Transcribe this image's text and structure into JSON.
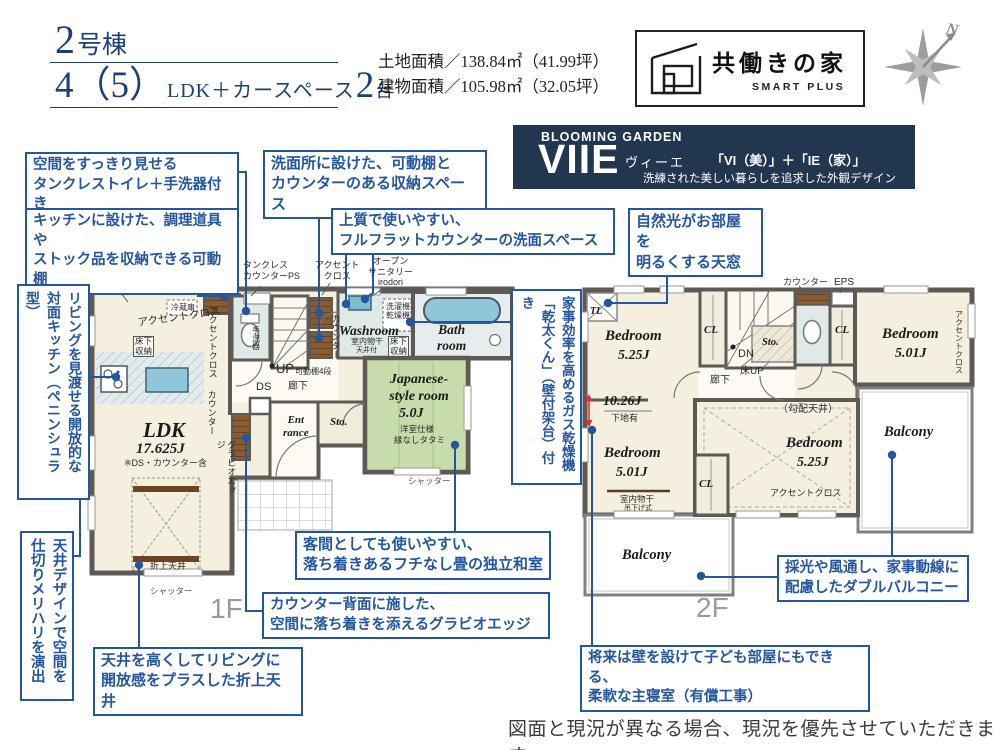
{
  "header": {
    "unit_num": "2",
    "unit_suffix": "号棟",
    "plan_num": "4（5）",
    "plan_mid": "LDK＋カースペース",
    "plan_num2": "2",
    "plan_unit": "台",
    "land_area": "土地面積／138.84㎡（41.99坪）",
    "building_area": "建物面積／105.98㎡（32.05坪）",
    "brand_name": "共働きの家",
    "brand_sub": "SMART PLUS",
    "compass_n": "N"
  },
  "banner": {
    "series": "BLOOMING GARDEN",
    "logo": "VIIE",
    "kana": "ヴィーエ",
    "formula": "「VI（美）」＋「IE（家）」",
    "tagline": "洗練された美しい暮らしを追求した外観デザイン"
  },
  "callouts": {
    "tankless": "空間をすっきり見せる\nタンクレストイレ＋手洗器付き",
    "kitchen_shelf": "キッチンに設けた、調理道具や\nストック品を収納できる可動棚",
    "washroom_storage": "洗面所に設けた、可動棚と\nカウンターのある収納スペース",
    "flat_counter": "上質で使いやすい、\nフルフラットカウンターの洗面スペース",
    "skylight": "自然光がお部屋を\n明るくする天窓",
    "peninsula": "リビングを見渡せる開放的な\n対面キッチン（ペニンシュラ型）",
    "ceiling_design": "天井デザインで空間を\n仕切りメリハリを演出",
    "gas_dryer": "家事効率を高めるガス乾燥機\n「乾太くん」（壁付架台）付き",
    "tatami": "客間としても使いやすい、\n落ち着きあるフチなし畳の独立和室",
    "gravio": "カウンター背面に施した、\n空間に落ち着きを添えるグラビオエッジ",
    "oriage": "天井を高くしてリビングに\n開放感をプラスした折上天井",
    "double_balcony": "採光や風通し、家事動線に\n配慮したダブルバルコニー",
    "main_bedroom": "将来は壁を設けて子ども部屋にもできる、\n柔軟な主寝室（有償工事）"
  },
  "plan1f": {
    "floor": "1F",
    "tenjo_dn": "天井DN",
    "kadoudana_top": "可動棚4段",
    "tankless_ps": "タンクレス\nカウンターPS",
    "reizouko": "冷蔵庫",
    "accent_diag": "アクセントクロス",
    "accent_vert": "アクセントクロス",
    "yukashita": "床下\n収納",
    "tearaiki": "手洗器",
    "popup": "ポップアップ天井",
    "ldk": "LDK",
    "ldk_size": "17.625J",
    "ldk_note": "※DS・カウンター含",
    "oriage": "折上天井",
    "shutter": "シャッター",
    "counter_v": "カウンター",
    "gravio_v": "グラビオエッジ",
    "up": "UP",
    "kadoudana_mid": "可動棚4段",
    "rouka": "廊下",
    "ds": "DS",
    "counter_v2": "カウンター",
    "accent_wash": "アクセント\nクロス",
    "open_sanitary": "オープン\nサニタリー\nirodori",
    "washer": "洗濯機\n乾燥機",
    "washroom": "Washroom",
    "monohoshi": "室内物干",
    "tenjotsuke": "天井付",
    "yukashita2": "床下\n収納",
    "bath": "Bath\nroom",
    "japanese": "Japanese-\nstyle room",
    "japanese_size": "5.0J",
    "japanese_note1": "洋室仕様",
    "japanese_note2": "縁なしタタミ",
    "sto": "Sto.",
    "entrance": "Ent\nrance",
    "shutter2": "シャッター"
  },
  "plan2f": {
    "floor": "2F",
    "tl": "TL",
    "bedroom1": "Bedroom",
    "bedroom1_size": "5.25J",
    "combined": "10.26J",
    "shitaji": "下地有",
    "bedroom2": "Bedroom",
    "bedroom2_size": "5.01J",
    "monohoshi": "室内物干",
    "tsurisage": "吊下げ式",
    "cl1": "CL",
    "cl2": "CL",
    "cl3": "CL",
    "dn": "DN",
    "sto": "Sto.",
    "yuka_up": "床UP",
    "rouka": "廊下",
    "counter": "カウンター",
    "eps": "EPS",
    "bedroom3": "Bedroom",
    "bedroom3_size": "5.01J",
    "accent_v": "アクセントクロス",
    "kobai": "（勾配天井）",
    "bedroom4": "Bedroom",
    "bedroom4_size": "5.25J",
    "accent_h": "アクセントクロス",
    "balcony1": "Balcony",
    "balcony2": "Balcony"
  },
  "footer": {
    "note": "図面と現況が異なる場合、現況を優先させていただきます。"
  },
  "colors": {
    "navy": "#2456a0",
    "header_navy": "#1c3f78",
    "banner_bg": "#22374f",
    "wall": "#5d5a56",
    "cream": "#f5efdf",
    "tatami": "#c8dcab",
    "wet": "#dfe9e8",
    "aqua": "#8fc6da",
    "wood": "#8a5a30"
  }
}
